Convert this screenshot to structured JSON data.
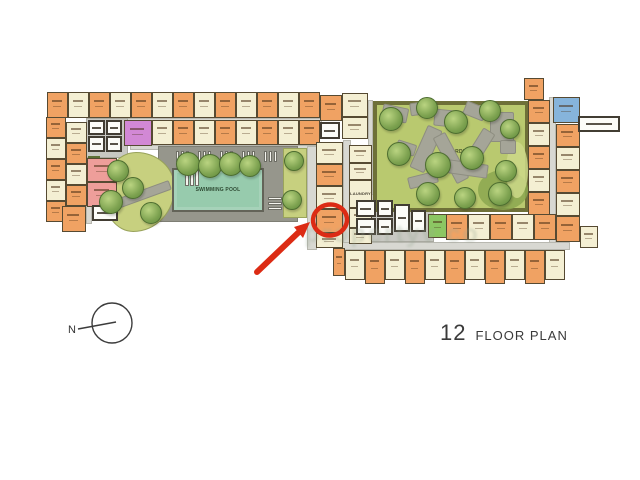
{
  "title": {
    "floor_number": "12",
    "label": "FLOOR PLAN"
  },
  "compass": {
    "label": "N"
  },
  "watermark": {
    "text": "propertyv co"
  },
  "labels": {
    "pool": "SWIMMING POOL",
    "garden_left": "GARDEN",
    "garden_right": "GARDEN",
    "laundry": "LAUNDRY"
  },
  "palette": {
    "orange": "#f0a263",
    "cream": "#f4efd3",
    "pink": "#ee9e9a",
    "purple": "#d288d5",
    "blue": "#86b4db",
    "green": "#8cc663",
    "room": "#fcfcf8",
    "corridor": "#d8d8d2",
    "deck": "#96968c",
    "base": "#c8c8c2",
    "planter": "#5d7036",
    "poolWater": "#97cbad",
    "gardenLeft": "#c7d07f",
    "gardenRight": "#b9c96f",
    "gardenBorder": "#6e7038",
    "stone": "#a5a598",
    "outline": "#564a32",
    "annotation": "#dc2b14",
    "text": "#3a3a3a",
    "watermark": "#98a894"
  },
  "plan": {
    "corridors": [
      [
        86,
        118,
        236,
        6,
        "corridor"
      ],
      [
        130,
        145,
        190,
        5,
        "corridor"
      ],
      [
        86,
        118,
        6,
        106,
        "corridor"
      ],
      [
        307,
        146,
        10,
        104,
        "corridor"
      ],
      [
        343,
        140,
        8,
        112,
        "corridor"
      ],
      [
        368,
        100,
        5,
        116,
        "corridor"
      ],
      [
        549,
        97,
        7,
        146,
        "corridor"
      ],
      [
        340,
        242,
        230,
        8,
        "corridor"
      ],
      [
        158,
        146,
        140,
        76,
        "deck"
      ],
      [
        86,
        118,
        42,
        40,
        "base"
      ],
      [
        352,
        194,
        82,
        48,
        "base"
      ],
      [
        283,
        148,
        24,
        70,
        "gstrip"
      ],
      [
        88,
        156,
        12,
        10,
        "planter"
      ]
    ],
    "garden_left": [
      103,
      152,
      70,
      78
    ],
    "garden_right": [
      373,
      101,
      156,
      111
    ],
    "patches": [
      {
        "x": 478,
        "y": 170,
        "w": 50,
        "h": 40,
        "c": "#8ba750"
      },
      {
        "x": 506,
        "y": 142,
        "w": 22,
        "h": 56,
        "c": "#ccd88a"
      }
    ],
    "stones": [
      [
        382,
        106,
        24,
        13,
        12
      ],
      [
        410,
        102,
        18,
        11,
        -8
      ],
      [
        434,
        110,
        28,
        15,
        6
      ],
      [
        464,
        104,
        20,
        12,
        22
      ],
      [
        490,
        112,
        22,
        28,
        0
      ],
      [
        418,
        126,
        14,
        44,
        24
      ],
      [
        444,
        132,
        12,
        50,
        -28
      ],
      [
        472,
        128,
        12,
        38,
        32
      ],
      [
        448,
        162,
        38,
        12,
        8
      ],
      [
        408,
        174,
        28,
        10,
        -14
      ],
      [
        396,
        142,
        18,
        10,
        18
      ],
      [
        500,
        140,
        14,
        12,
        0
      ],
      [
        112,
        190,
        58,
        8,
        -20
      ]
    ],
    "pool": [
      172,
      168,
      92,
      44
    ],
    "chairs": [
      [
        176,
        151,
        3,
        11
      ],
      [
        181,
        151,
        3,
        11
      ],
      [
        186,
        151,
        3,
        11
      ],
      [
        198,
        151,
        3,
        11
      ],
      [
        203,
        151,
        3,
        11
      ],
      [
        208,
        151,
        3,
        11
      ],
      [
        220,
        151,
        3,
        11
      ],
      [
        225,
        151,
        3,
        11
      ],
      [
        230,
        151,
        3,
        11
      ],
      [
        242,
        151,
        3,
        11
      ],
      [
        247,
        151,
        3,
        11
      ],
      [
        252,
        151,
        3,
        11
      ],
      [
        264,
        151,
        3,
        11
      ],
      [
        269,
        151,
        3,
        11
      ],
      [
        274,
        151,
        3,
        11
      ],
      [
        185,
        170,
        4,
        16
      ],
      [
        190,
        170,
        4,
        16
      ],
      [
        195,
        170,
        4,
        16
      ],
      [
        268,
        197,
        14,
        3
      ],
      [
        268,
        202,
        14,
        3
      ],
      [
        268,
        207,
        14,
        3
      ]
    ],
    "units": [
      [
        47,
        92,
        21,
        26,
        "o"
      ],
      [
        68,
        92,
        21,
        26,
        "c"
      ],
      [
        89,
        92,
        21,
        26,
        "o"
      ],
      [
        110,
        92,
        21,
        26,
        "c"
      ],
      [
        131,
        92,
        21,
        26,
        "o"
      ],
      [
        152,
        92,
        21,
        26,
        "c"
      ],
      [
        173,
        92,
        21,
        26,
        "o"
      ],
      [
        194,
        92,
        21,
        26,
        "c"
      ],
      [
        215,
        92,
        21,
        26,
        "o"
      ],
      [
        236,
        92,
        21,
        26,
        "c"
      ],
      [
        257,
        92,
        21,
        26,
        "o"
      ],
      [
        278,
        92,
        21,
        26,
        "c"
      ],
      [
        299,
        92,
        21,
        26,
        "o"
      ],
      [
        152,
        120,
        21,
        25,
        "c"
      ],
      [
        173,
        120,
        21,
        25,
        "o"
      ],
      [
        194,
        120,
        21,
        25,
        "c"
      ],
      [
        215,
        120,
        21,
        25,
        "o"
      ],
      [
        236,
        120,
        21,
        25,
        "c"
      ],
      [
        257,
        120,
        21,
        25,
        "o"
      ],
      [
        278,
        120,
        21,
        25,
        "c"
      ],
      [
        299,
        120,
        21,
        25,
        "o"
      ],
      [
        124,
        120,
        28,
        26,
        "v",
        "purple-unit"
      ],
      [
        46,
        117,
        20,
        21,
        "o"
      ],
      [
        46,
        138,
        20,
        21,
        "c"
      ],
      [
        46,
        159,
        20,
        21,
        "o"
      ],
      [
        46,
        180,
        20,
        21,
        "c"
      ],
      [
        46,
        201,
        20,
        21,
        "o"
      ],
      [
        66,
        122,
        21,
        21,
        "c"
      ],
      [
        66,
        143,
        21,
        21,
        "o"
      ],
      [
        66,
        164,
        21,
        21,
        "c"
      ],
      [
        66,
        185,
        21,
        21,
        "o"
      ],
      [
        62,
        206,
        24,
        26,
        "o"
      ],
      [
        87,
        158,
        30,
        24,
        "p",
        "pink-unit"
      ],
      [
        87,
        182,
        30,
        25,
        "p",
        "pink-unit"
      ],
      [
        320,
        95,
        22,
        26,
        "o"
      ],
      [
        342,
        93,
        26,
        24,
        "c"
      ],
      [
        342,
        117,
        26,
        22,
        "c"
      ],
      [
        316,
        142,
        27,
        22,
        "c"
      ],
      [
        316,
        164,
        27,
        22,
        "o"
      ],
      [
        316,
        186,
        27,
        23,
        "c"
      ],
      [
        316,
        209,
        27,
        24,
        "o",
        "highlighted-unit"
      ],
      [
        316,
        233,
        27,
        15,
        "c"
      ],
      [
        349,
        145,
        23,
        18,
        "c"
      ],
      [
        349,
        163,
        23,
        17,
        "c"
      ],
      [
        349,
        208,
        23,
        20,
        "c"
      ],
      [
        349,
        228,
        23,
        16,
        "c"
      ],
      [
        528,
        100,
        22,
        23,
        "o"
      ],
      [
        528,
        123,
        22,
        23,
        "c"
      ],
      [
        528,
        146,
        22,
        23,
        "o"
      ],
      [
        528,
        169,
        22,
        23,
        "c"
      ],
      [
        528,
        192,
        22,
        23,
        "o"
      ],
      [
        524,
        78,
        20,
        22,
        "o"
      ],
      [
        553,
        97,
        27,
        26,
        "b",
        "blue-unit"
      ],
      [
        556,
        124,
        24,
        23,
        "o"
      ],
      [
        556,
        147,
        24,
        23,
        "c"
      ],
      [
        556,
        170,
        24,
        23,
        "o"
      ],
      [
        556,
        193,
        24,
        23,
        "c"
      ],
      [
        556,
        216,
        24,
        26,
        "o"
      ],
      [
        580,
        226,
        18,
        22,
        "c"
      ],
      [
        428,
        214,
        20,
        24,
        "g",
        "green-unit"
      ],
      [
        446,
        214,
        22,
        26,
        "o"
      ],
      [
        468,
        214,
        22,
        26,
        "c"
      ],
      [
        490,
        214,
        22,
        26,
        "o"
      ],
      [
        512,
        214,
        22,
        26,
        "c"
      ],
      [
        534,
        214,
        22,
        26,
        "o"
      ],
      [
        333,
        248,
        12,
        28,
        "o"
      ],
      [
        345,
        250,
        20,
        30,
        "c"
      ],
      [
        365,
        250,
        20,
        34,
        "o"
      ],
      [
        385,
        250,
        20,
        30,
        "c"
      ],
      [
        405,
        250,
        20,
        34,
        "o"
      ],
      [
        425,
        250,
        20,
        30,
        "c"
      ],
      [
        445,
        250,
        20,
        34,
        "o"
      ],
      [
        465,
        250,
        20,
        30,
        "c"
      ],
      [
        485,
        250,
        20,
        34,
        "o"
      ],
      [
        505,
        250,
        20,
        30,
        "c"
      ],
      [
        525,
        250,
        20,
        34,
        "o"
      ],
      [
        545,
        250,
        20,
        30,
        "c"
      ]
    ],
    "laundry_room": [
      349,
      180,
      23,
      28
    ],
    "rooms": [
      [
        88,
        120,
        17,
        15
      ],
      [
        106,
        120,
        16,
        15
      ],
      [
        88,
        136,
        17,
        16
      ],
      [
        106,
        136,
        16,
        16
      ],
      [
        92,
        205,
        26,
        16
      ],
      [
        320,
        122,
        20,
        17
      ],
      [
        356,
        200,
        20,
        17
      ],
      [
        377,
        200,
        16,
        17
      ],
      [
        356,
        218,
        20,
        17
      ],
      [
        377,
        218,
        16,
        17
      ],
      [
        394,
        204,
        16,
        28
      ],
      [
        411,
        210,
        15,
        22
      ],
      [
        578,
        116,
        42,
        16
      ]
    ],
    "trees": [
      [
        117,
        170,
        10
      ],
      [
        110,
        201,
        11
      ],
      [
        132,
        187,
        10
      ],
      [
        150,
        212,
        10
      ],
      [
        293,
        160,
        9
      ],
      [
        291,
        199,
        9
      ],
      [
        187,
        163,
        11
      ],
      [
        209,
        165,
        11
      ],
      [
        230,
        163,
        11
      ],
      [
        249,
        165,
        10
      ],
      [
        390,
        118,
        11
      ],
      [
        426,
        107,
        10
      ],
      [
        455,
        121,
        11
      ],
      [
        489,
        110,
        10
      ],
      [
        509,
        128,
        9
      ],
      [
        398,
        153,
        11
      ],
      [
        437,
        164,
        12
      ],
      [
        471,
        157,
        11
      ],
      [
        505,
        170,
        10
      ],
      [
        427,
        193,
        11
      ],
      [
        464,
        197,
        10
      ],
      [
        499,
        193,
        11
      ]
    ],
    "annotation": {
      "circle": {
        "cx": 330,
        "cy": 220,
        "rx": 17,
        "ry": 15.5,
        "rot": -8
      },
      "arrow_shaft": {
        "x1": 257,
        "y1": 272,
        "x2": 300,
        "y2": 231
      },
      "arrow_head": "310,222 303,238 294,227"
    },
    "label_positions": {
      "pool_center": true,
      "garden_left_offset": [
        24,
        36
      ],
      "garden_right_offset": [
        70,
        44
      ]
    }
  }
}
